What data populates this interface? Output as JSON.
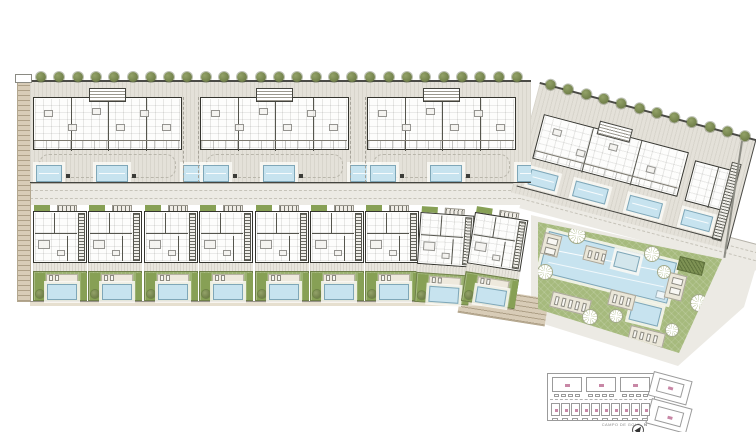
{
  "title": "Residential development master site plan",
  "plan": {
    "annotation": "CAMPO DE GOLF",
    "north_label": "N",
    "top_row": {
      "blocks": 3,
      "units_per_block": 4,
      "pools_per_block": 3,
      "trees": 27
    },
    "angled_row": {
      "buildings": 2,
      "pools": 4,
      "trees": 12
    },
    "townhouse_row": {
      "units": 9
    },
    "communal": {
      "palms": 8,
      "lounger_pads": 6,
      "pools": 3
    },
    "key_plan": {
      "blocks": 3,
      "houses": 10
    }
  },
  "colors": {
    "deck": "#e4e1d9",
    "road": "#eceae4",
    "wall": "#35352f",
    "pool": "#c7e3ef",
    "pool_border": "#7fa7b8",
    "lawn": "#a6ba7d",
    "garden": "#9cb272",
    "tree": "#76854e",
    "path": "#d8ccb7",
    "hedge": "#7e9254",
    "keyline": "#9b9b9b",
    "pink": "#c887a6"
  }
}
